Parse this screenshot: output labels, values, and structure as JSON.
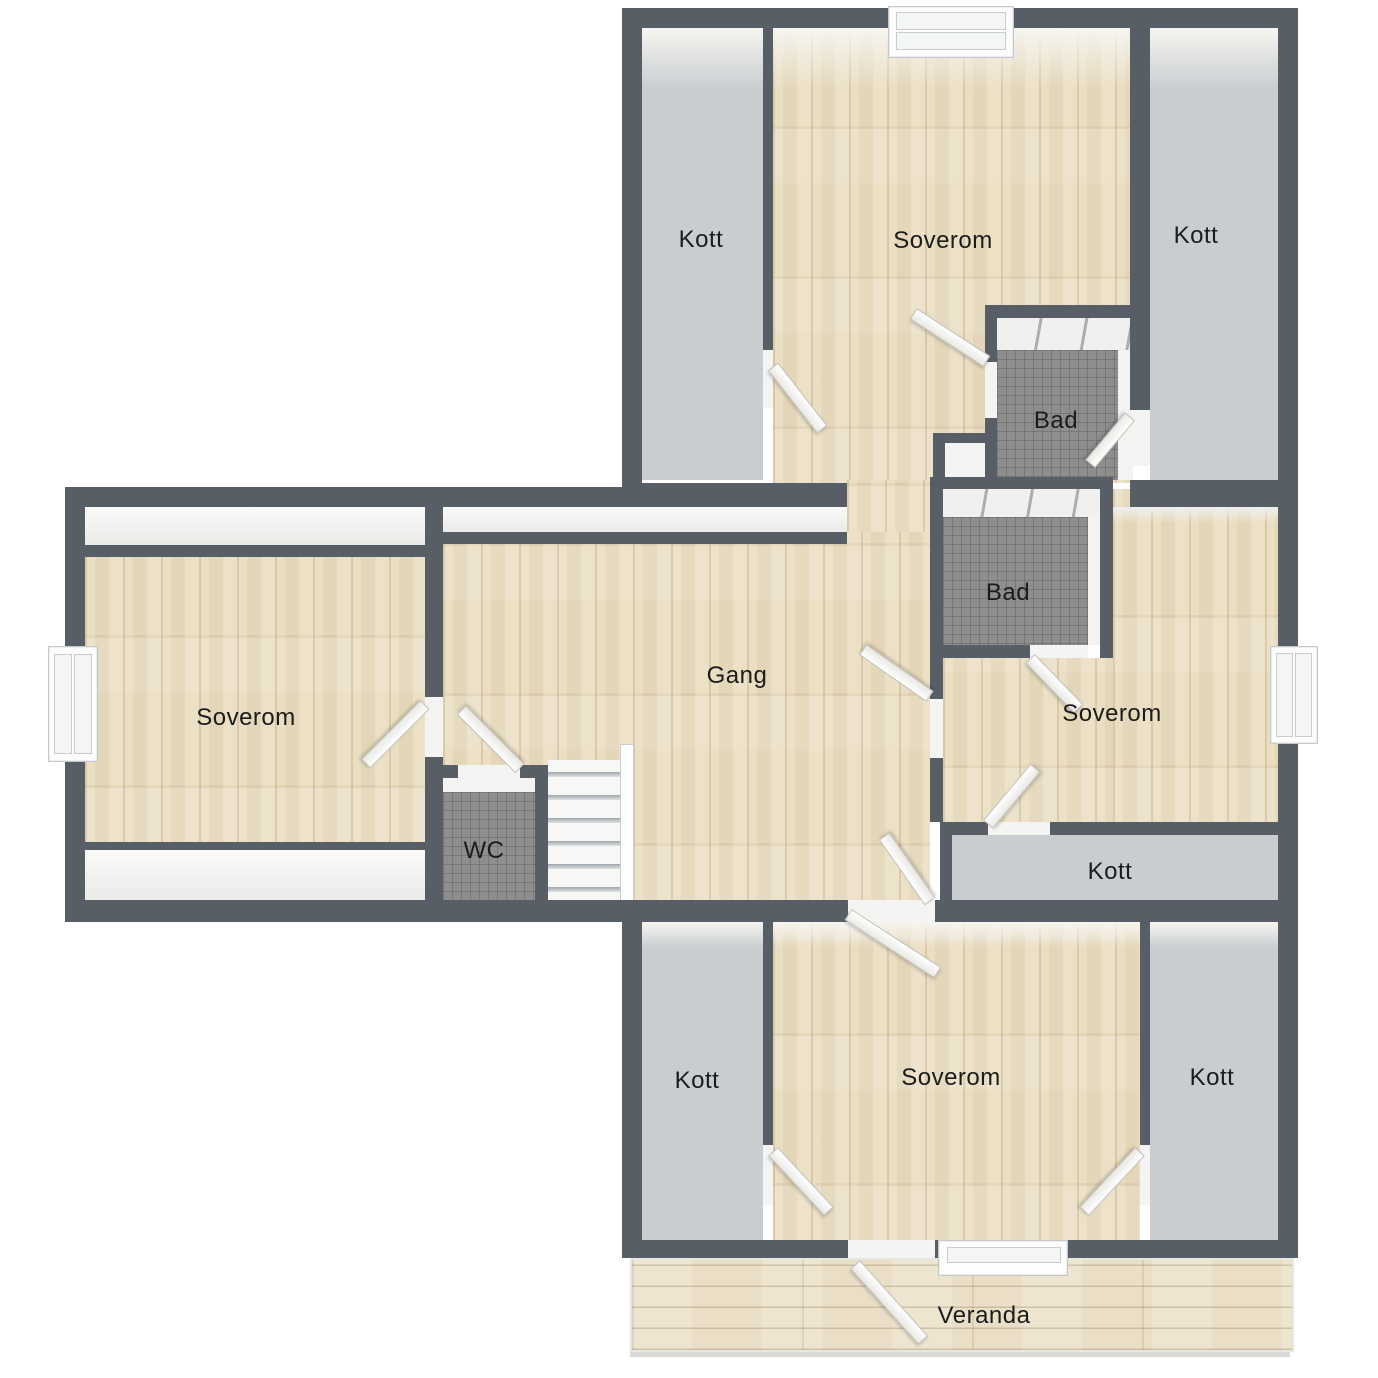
{
  "title": "Floor plan - upper storey",
  "labels": {
    "kott_top_left": "Kott",
    "soverom_top": "Soverom",
    "kott_top_right": "Kott",
    "bad_top": "Bad",
    "bad_mid": "Bad",
    "soverom_left": "Soverom",
    "gang": "Gang",
    "soverom_right": "Soverom",
    "wc": "WC",
    "kott_mid_right": "Kott",
    "kott_bottom_left": "Kott",
    "soverom_bottom": "Soverom",
    "kott_bottom_right": "Kott",
    "veranda": "Veranda"
  },
  "colors": {
    "wall": "#585e66",
    "wood": "#e8dabc",
    "kott": "#c9cdd0",
    "tile": "#8e8e8e",
    "veranda": "#eadfc6",
    "label": "#1c1c1c"
  }
}
